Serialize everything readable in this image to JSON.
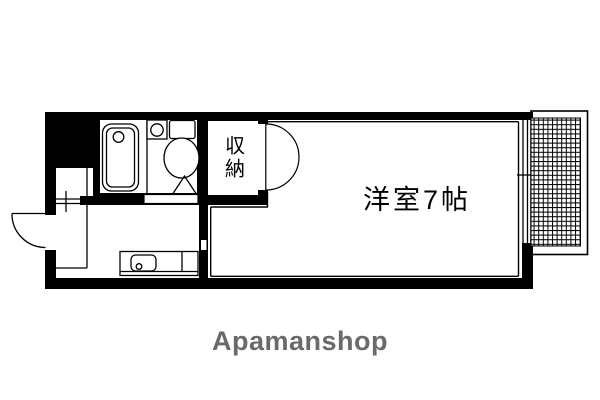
{
  "plan": {
    "room": {
      "label": "洋室7帖"
    },
    "closet": {
      "label": "収納"
    },
    "fixtures": [
      "bathtub-icon",
      "toilet-icon",
      "bathroom-sink-icon",
      "kitchen-sink-icon",
      "entrance-door-swing",
      "closet-double-door-swing",
      "bathroom-door-swing",
      "sliding-window",
      "balcony-hatch",
      "entry-step-lines"
    ]
  },
  "branding": {
    "logo_text": "Apamanshop"
  },
  "colors": {
    "wall": "#000000",
    "line": "#000000",
    "background": "#ffffff",
    "logo_gray": "#6a6a6a"
  }
}
